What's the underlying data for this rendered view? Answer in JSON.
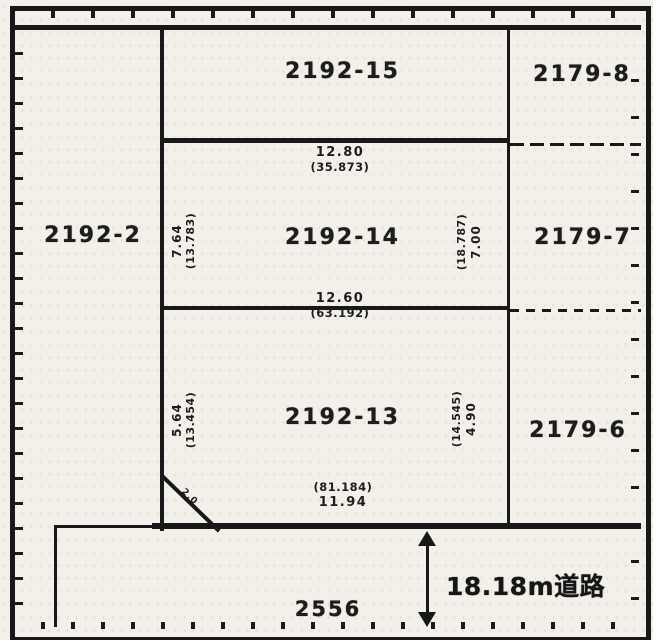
{
  "parcels": {
    "p2192_2": "2192-2",
    "p2192_15": "2192-15",
    "p2192_14": "2192-14",
    "p2192_13": "2192-13",
    "p2179_8": "2179-8",
    "p2179_7": "2179-7",
    "p2179_6": "2179-6",
    "p2556": "2556"
  },
  "measurements": {
    "top": {
      "value": "12.80",
      "paren": "(35.873)"
    },
    "middle": {
      "value": "12.60",
      "paren": "(63.192)"
    },
    "bottom": {
      "value": "11.94",
      "paren": "(81.184)"
    },
    "left_upper": {
      "value": "7.64",
      "paren": "(13.783)"
    },
    "right_upper": {
      "value": "7.00",
      "paren": "(18.787)"
    },
    "left_lower": {
      "value": "5.64",
      "paren": "(13.454)"
    },
    "right_lower": {
      "value": "4.90",
      "paren": "(14.545)"
    },
    "corner": "2.0"
  },
  "road": {
    "width_label": "18.18m道路"
  },
  "colors": {
    "ink": "#181818",
    "paper": "#f2f0e9"
  }
}
